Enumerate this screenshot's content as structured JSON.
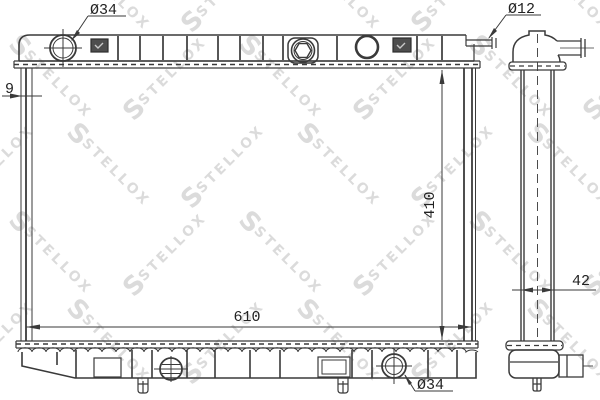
{
  "watermark": {
    "logo": "S",
    "text": "STELLOX",
    "color": "#aaaaaa"
  },
  "drawing": {
    "type": "radiator technical line drawing, front view and side view",
    "line_color": "#3a3a3a",
    "background": "#ffffff",
    "dimensions": {
      "top_cap_diameter": "Ø34",
      "top_right_pipe_diameter": "Ø12",
      "core_thickness": "9",
      "core_height": "410",
      "core_width": "610",
      "side_profile_width": "42",
      "bottom_drain_diameter": "Ø34"
    }
  }
}
